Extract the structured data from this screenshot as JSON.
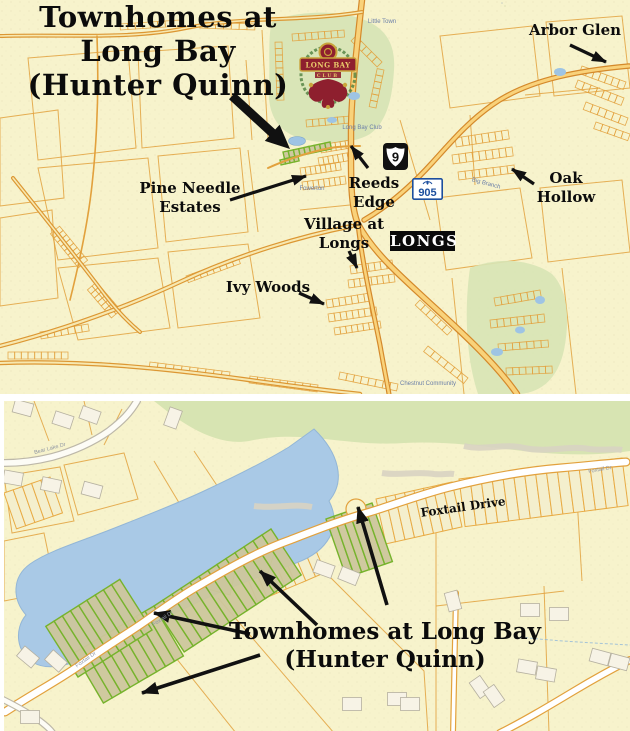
{
  "top_map": {
    "title_lines": [
      "Townhomes at",
      "Long Bay",
      "(Hunter Quinn)"
    ],
    "neighborhoods": {
      "arbor_glen": "Arbor Glen",
      "pine_needle_line1": "Pine Needle",
      "pine_needle_line2": "Estates",
      "reeds_edge_line1": "Reeds",
      "reeds_edge_line2": "Edge",
      "village_at_longs_line1": "Village at",
      "village_at_longs_line2": "Longs",
      "ivy_woods": "Ivy Woods",
      "oak_hollow_line1": "Oak",
      "oak_hollow_line2": "Hollow"
    },
    "route_shields": {
      "us9": "9",
      "sc905": "905"
    },
    "town_badge": "LONGS",
    "crest": {
      "line1": "LONG BAY",
      "line2": "CLUB"
    },
    "street_labels": {
      "little_town": "Little Town",
      "long_bay_club": "Long Bay Club",
      "fowerton": "Fowerton",
      "big_branch": "Big Branch",
      "chestnut_community": "Chestnut Community"
    }
  },
  "bottom_map": {
    "road_label": "Foxtail Drive",
    "title_lines": [
      "Townhomes at Long Bay",
      "(Hunter Quinn)"
    ],
    "street_labels": {
      "foxtail_small": "Foxtail Dr",
      "bear_lake": "Bear Lake Dr"
    }
  },
  "colors": {
    "map_background": "#f7f3cc",
    "parcel_line": "#e2a13d",
    "road_fill": "#f9d27a",
    "golf_green": "#d7e4b5",
    "lake_blue": "#a9c9e6",
    "townhome_lot_fill": "#ccc69c",
    "townhome_lot_stroke": "#76b32c",
    "arrow_black": "#111111",
    "shield_blue": "#1d4f9e",
    "crest_maroon": "#8e1f2e",
    "crest_gold": "#c9a43b",
    "town_badge_bg": "#000000",
    "town_badge_text": "#ffffff"
  }
}
